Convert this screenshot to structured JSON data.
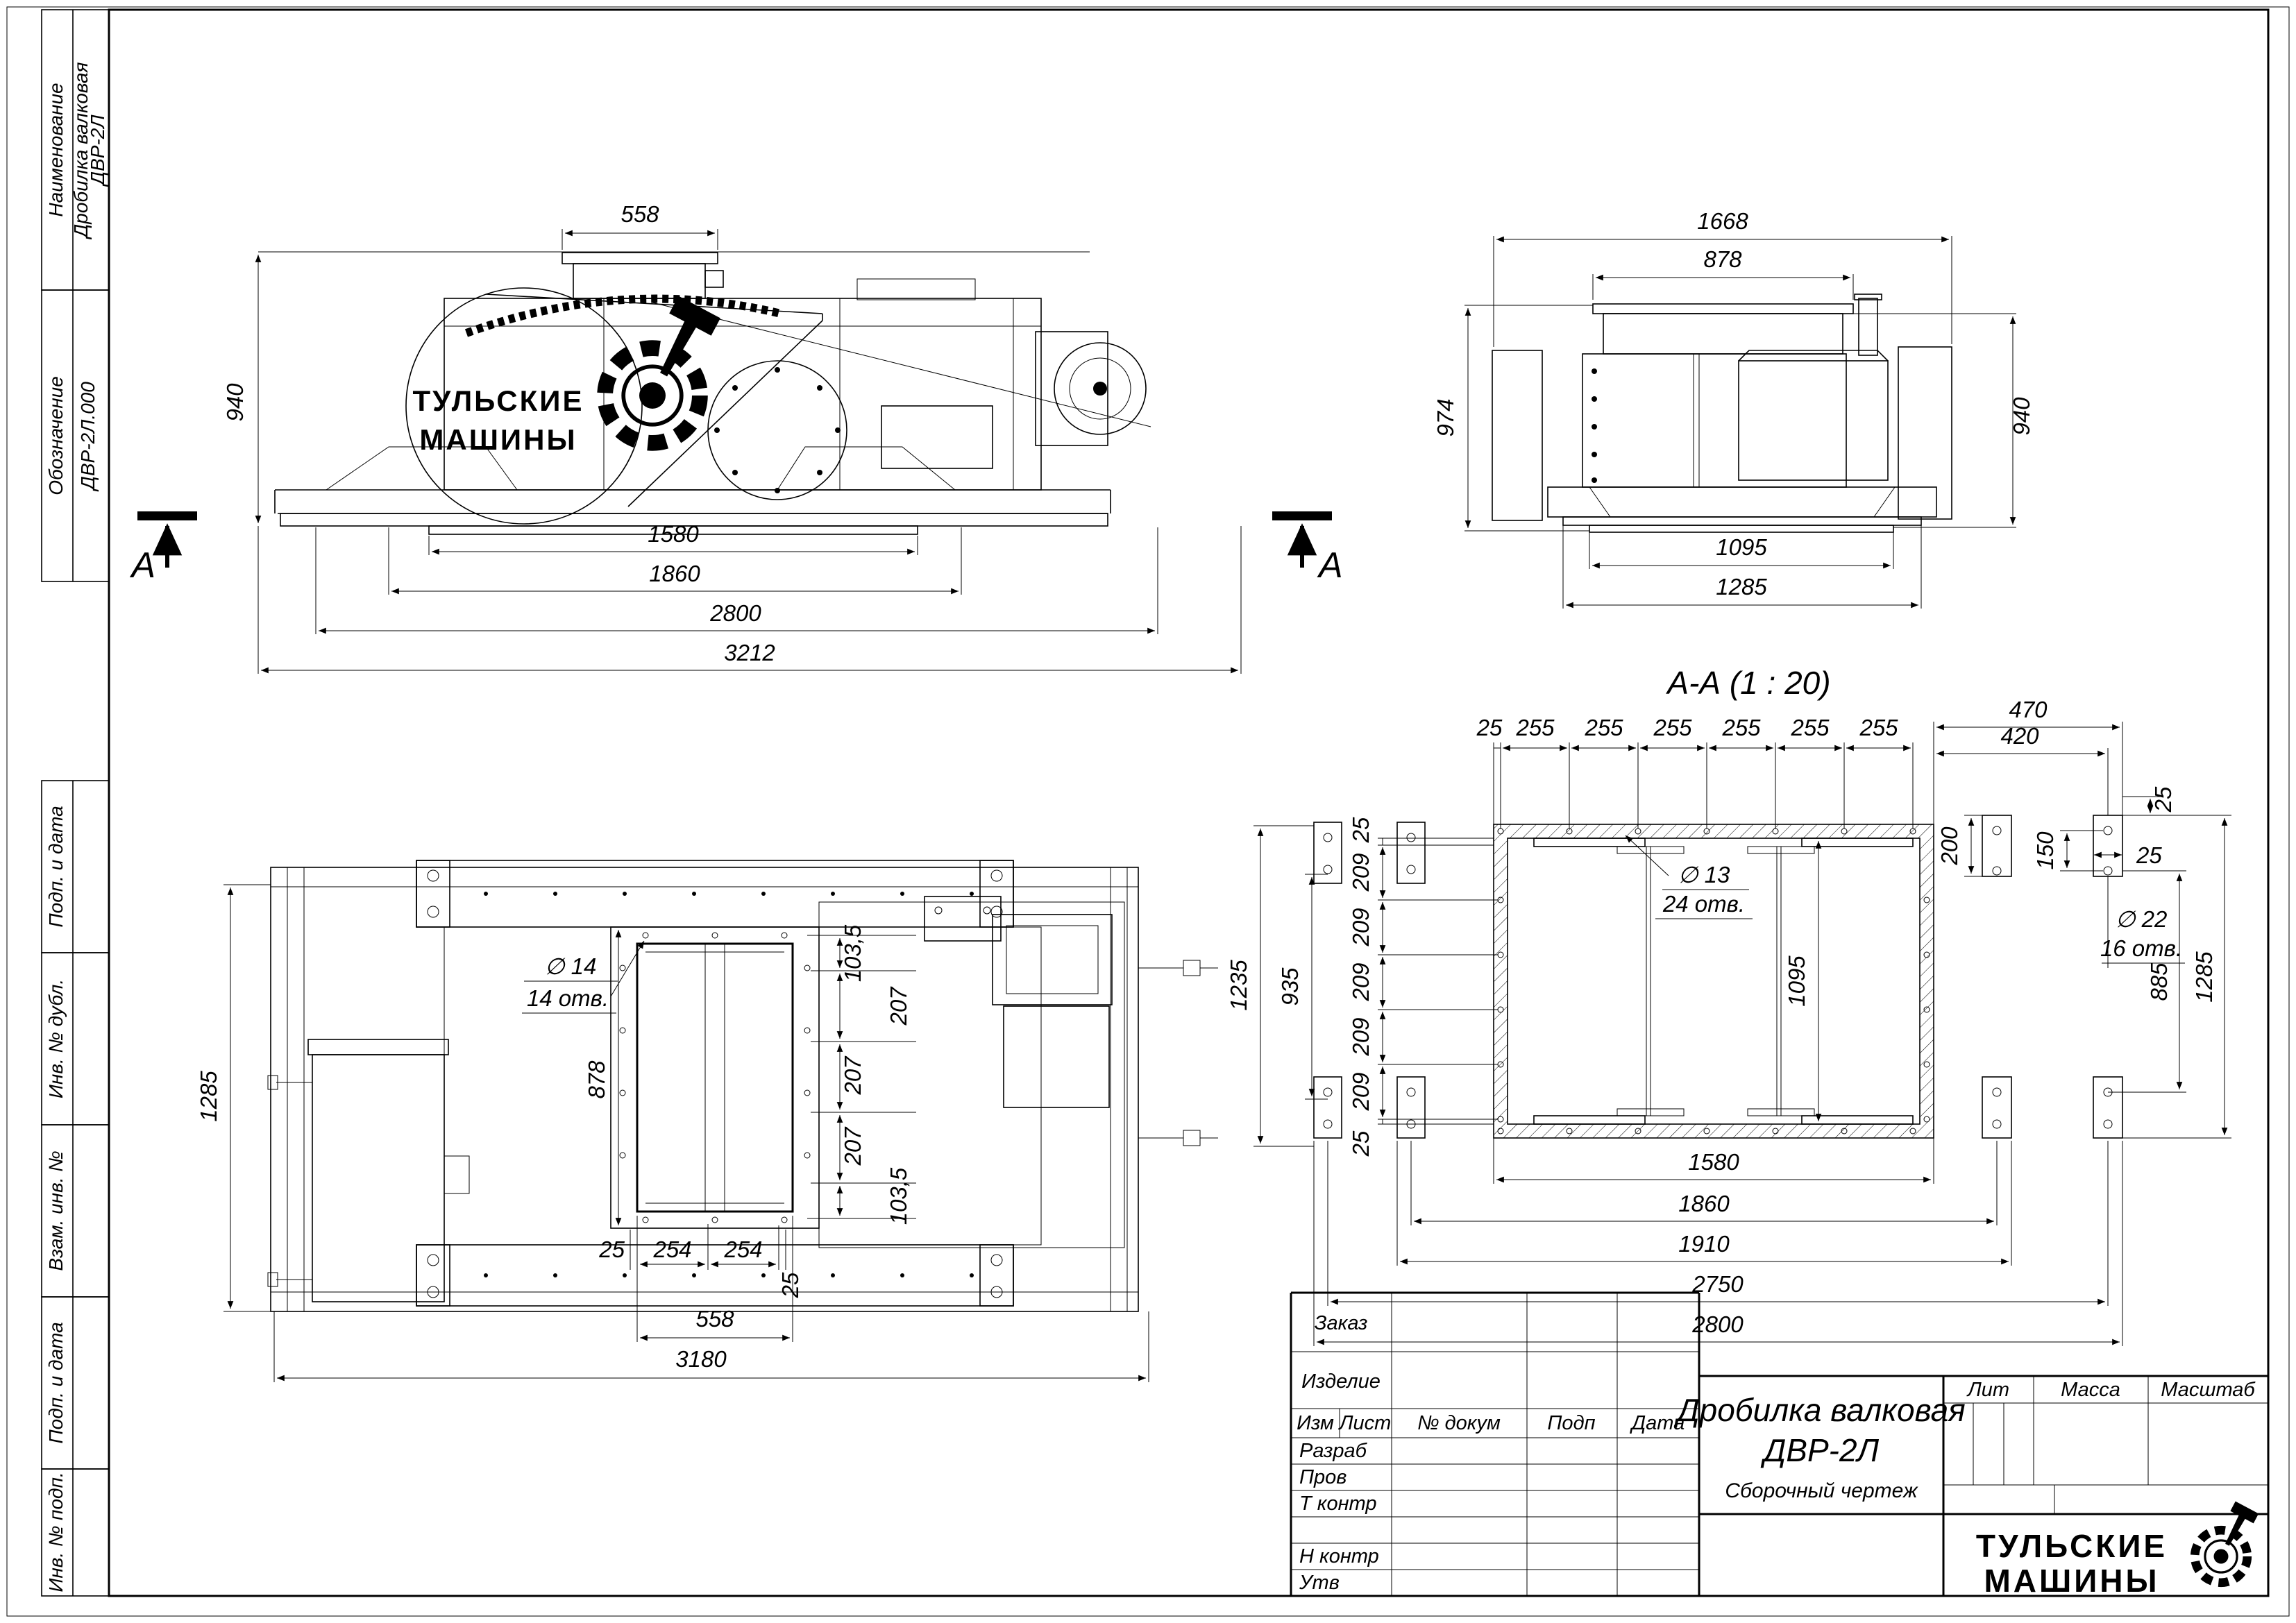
{
  "drawing": {
    "stamp": {
      "name_label": "Наименование",
      "name_value1": "Дробилка валковая",
      "name_value2": "ДВР-2Л",
      "code_label": "Обозначение",
      "code_value": "ДВР-2Л.000",
      "vert_labels": [
        "Подп. и дата",
        "Инв. № дубл.",
        "Взам. инв. №",
        "Подп. и дата",
        "Инв. № подп."
      ]
    },
    "marker": {
      "letter": "А"
    },
    "side": {
      "logo1": "ТУЛЬСКИЕ",
      "logo2": "МАШИНЫ",
      "dim_top": "558",
      "dim_height": "940",
      "bottom_dims": [
        "1580",
        "1860",
        "2800",
        "3212"
      ]
    },
    "end": {
      "dim_w1": "1668",
      "dim_w2": "878",
      "dim_hl": "974",
      "dim_hr": "940",
      "dim_b1": "1095",
      "dim_b2": "1285"
    },
    "plan": {
      "dim_w": "1285",
      "hole_d": "∅ 14",
      "hole_n": "14 отв.",
      "dim_inner": "878",
      "vchain": [
        "103,5",
        "207",
        "207",
        "207",
        "103,5"
      ],
      "hchain": [
        "25",
        "254",
        "254",
        "25"
      ],
      "dim_open": "558",
      "dim_total": "3180"
    },
    "section": {
      "title": "А-А (1 : 20)",
      "top_chain": [
        "25",
        "255",
        "255",
        "255",
        "255",
        "255",
        "255"
      ],
      "left_25t": "25",
      "left_25b": "25",
      "left_chain": [
        "209",
        "209",
        "209",
        "209",
        "209"
      ],
      "dim_935": "935",
      "dim_1235": "1235",
      "dim_inner": "1095",
      "dim_470": "470",
      "dim_420": "420",
      "dim_25a": "25",
      "dim_200": "200",
      "dim_150": "150",
      "dim_25b": "25",
      "dim_885": "885",
      "dim_1285": "1285",
      "bottom_chain": [
        "1580",
        "1860",
        "1910",
        "2750",
        "2800"
      ],
      "hole13_d": "∅ 13",
      "hole13_n": "24 отв.",
      "hole22_d": "∅ 22",
      "hole22_n": "16 отв."
    },
    "tb": {
      "order": "Заказ",
      "product": "Изделие",
      "header": [
        "Изм",
        "Лист",
        "№ докум",
        "Подп",
        "Дата"
      ],
      "rows": [
        "Разраб",
        "Пров",
        "Т контр",
        "Н контр",
        "Утв"
      ],
      "title1": "Дробилка валковая",
      "title2": "ДВР-2Л",
      "subtitle": "Сборочный чертеж",
      "lit": "Лит",
      "mass": "Масса",
      "scale": "Масштаб",
      "logo1": "ТУЛЬСКИЕ",
      "logo2": "МАШИНЫ"
    }
  }
}
